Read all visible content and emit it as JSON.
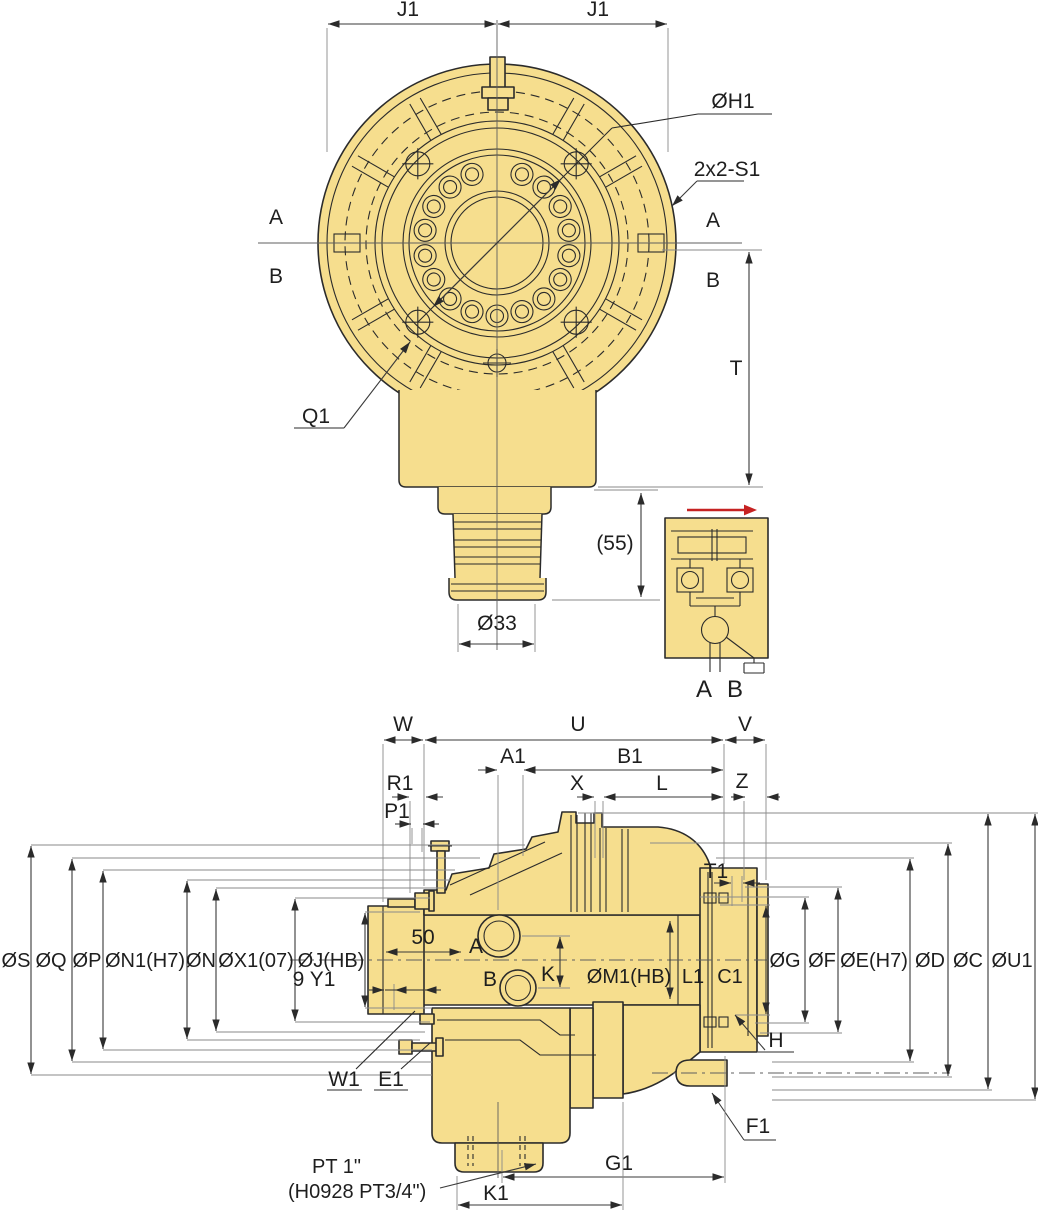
{
  "colors": {
    "body": "#F6DE8E",
    "outline": "#2B2B2B",
    "dim_line": "#3A3A3A",
    "extension_line": "#8A8A8A",
    "arrow_red": "#C62222",
    "background": "#FFFFFF"
  },
  "top_view": {
    "dim_j1_left": "J1",
    "dim_j1_right": "J1",
    "label_h1": "ØH1",
    "label_s1": "2x2-S1",
    "section_a_left": "A",
    "section_b_left": "B",
    "section_a_right": "A",
    "section_b_right": "B",
    "dim_t": "T",
    "label_q1": "Q1",
    "dim_55": "(55)",
    "dim_33": "Ø33"
  },
  "detail_view": {
    "port_a": "A",
    "port_b": "B"
  },
  "side_view": {
    "dim_w": "W",
    "dim_u": "U",
    "dim_v": "V",
    "dim_a1": "A1",
    "dim_b1": "B1",
    "dim_r1": "R1",
    "dim_p1": "P1",
    "dim_x": "X",
    "dim_l": "L",
    "dim_z": "Z",
    "dim_t1": "T1",
    "left_dims": [
      "ØS",
      "ØQ",
      "ØP",
      "ØN1(H7)",
      "ØN",
      "ØX1(07)",
      "ØJ(HB)"
    ],
    "right_dims": [
      "ØG",
      "ØF",
      "ØE(H7)",
      "ØD",
      "ØC",
      "ØU1"
    ],
    "dim_50": "50",
    "dim_9_y1": "9 Y1",
    "port_a": "A",
    "port_b": "B",
    "dim_k": "K",
    "dim_m1": "ØM1(HB)",
    "dim_l1": "L1",
    "dim_c1": "C1",
    "label_w1": "W1",
    "label_e1": "E1",
    "label_h": "H",
    "label_f1": "F1",
    "dim_g1": "G1",
    "dim_k1": "K1",
    "note_pt_line1": "PT 1\"",
    "note_pt_line2": "(H0928 PT3/4\")"
  }
}
